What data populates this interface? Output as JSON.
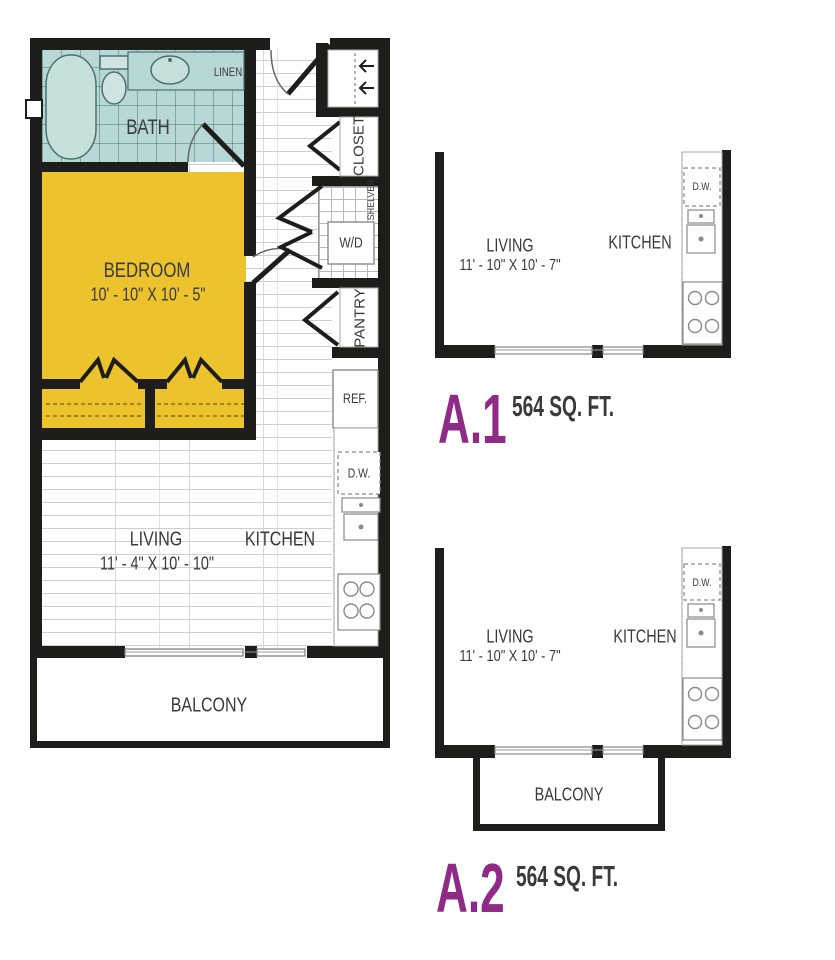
{
  "palette": {
    "wall": "#1d1d1b",
    "bath_teal": "#b7d8d6",
    "bedroom_yellow": "#ecc22d",
    "accent_purple": "#8f2a87",
    "label_gray": "#3a3a3a"
  },
  "main_plan": {
    "bath_label": "BATH",
    "linen_label": "LINEN",
    "closet_label": "CLOSET",
    "shelves_label": "SHELVES",
    "washer_dryer_label": "W/D",
    "pantry_label": "PANTRY",
    "refrigerator_label": "REF.",
    "dishwasher_label": "D.W.",
    "bedroom_label": "BEDROOM",
    "bedroom_dims": "10' - 10\" X 10' - 5\"",
    "living_label": "LIVING",
    "living_dims": "11' - 4\" X 10' - 10\"",
    "kitchen_label": "KITCHEN",
    "balcony_label": "BALCONY"
  },
  "unit_a1": {
    "name": "A.1",
    "area": "564 SQ. FT.",
    "living_label": "LIVING",
    "living_dims": "11' - 10\" X 10' - 7\"",
    "kitchen_label": "KITCHEN",
    "dishwasher_label": "D.W."
  },
  "unit_a2": {
    "name": "A.2",
    "area": "564 SQ. FT.",
    "living_label": "LIVING",
    "living_dims": "11' - 10\" X 10' - 7\"",
    "kitchen_label": "KITCHEN",
    "dishwasher_label": "D.W.",
    "balcony_label": "BALCONY"
  }
}
